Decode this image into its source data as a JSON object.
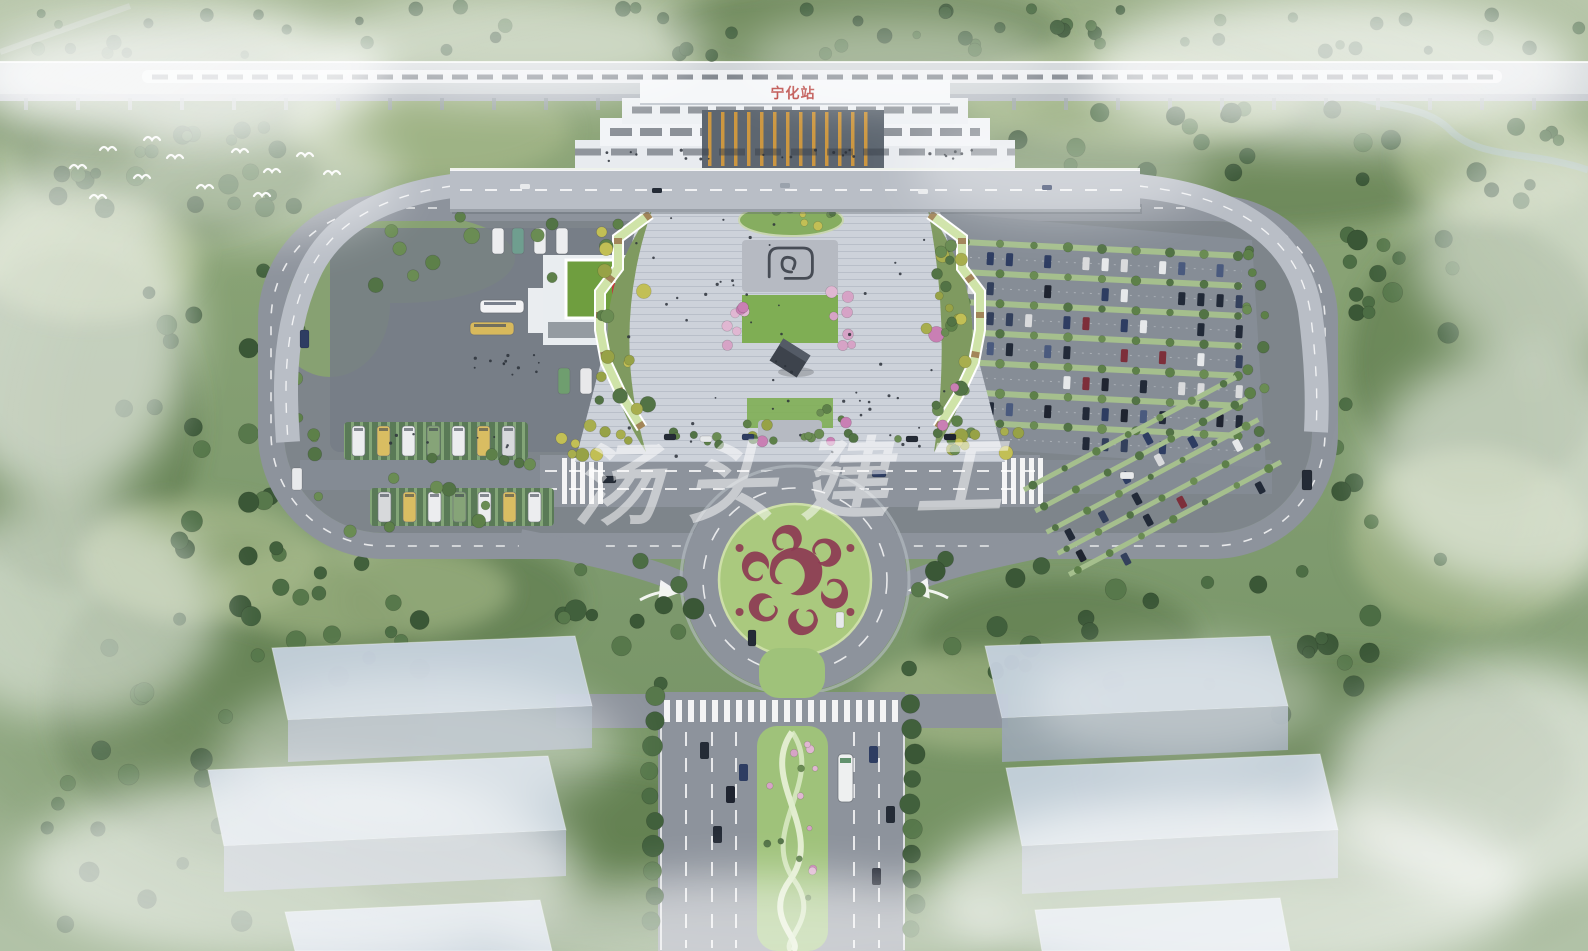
{
  "station": {
    "sign_text": "宁化站",
    "sign_color": "#b8403c"
  },
  "watermark": {
    "text": "汤头建工",
    "color": "#ffffff",
    "opacity": "0.52"
  },
  "palette": {
    "terrain_green": "#87a172",
    "forest_green": "#4c6d44",
    "asphalt": "#8d939c",
    "asphalt_dark": "#7e858b",
    "plaza_paving": "#cdd2da",
    "lawn_green": "#7fae54",
    "pergola_green": "#cfe3a8",
    "terminal_roof_green": "#6f9e3f",
    "roundabout_bed_green": "#aac97e",
    "cloud_motif_maroon": "#8d3a52",
    "flower_pink": "#d6a3c6",
    "building_white": "#f2f4f6",
    "rail_deck_gray": "#cfd3d8",
    "massing_block_gray": "#c2cdd9",
    "fog_white": "#ffffff"
  }
}
